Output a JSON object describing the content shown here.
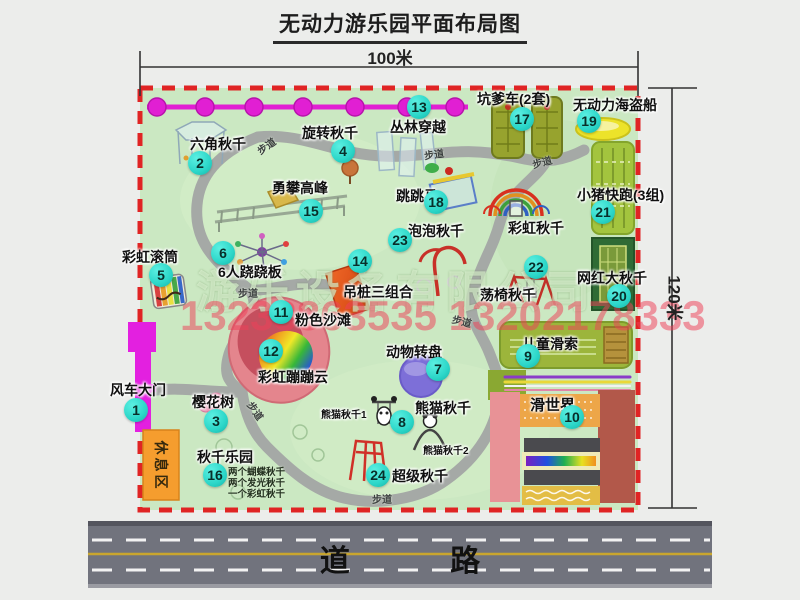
{
  "title": "无动力游乐园平面布局图",
  "dimensions": {
    "width_label": "100米",
    "height_label": "120米"
  },
  "road": {
    "label": "道 路"
  },
  "watermark": {
    "company": "游乐设备有限公司",
    "phone": "13233863535 13202178333"
  },
  "colors": {
    "map_green": "#cbe8c2",
    "border_red": "#e02424",
    "badge_cyan": "#2bd6c8",
    "chain_magenta": "#e11fd3",
    "gate_magenta": "#e320e0",
    "rest_area_orange": "#f59d2e",
    "road_gray": "#71737d"
  },
  "attractions": [
    {
      "num": "1",
      "name": "风车大门"
    },
    {
      "num": "2",
      "name": "六角秋千"
    },
    {
      "num": "3",
      "name": "樱花树"
    },
    {
      "num": "4",
      "name": "旋转秋千"
    },
    {
      "num": "5",
      "name": "彩虹滚筒"
    },
    {
      "num": "6",
      "name": "6人跷跷板"
    },
    {
      "num": "7",
      "name": "动物转盘"
    },
    {
      "num": "8",
      "name": "熊猫秋千"
    },
    {
      "num": "9",
      "name": "儿童滑索"
    },
    {
      "num": "10",
      "name": "滑世界"
    },
    {
      "num": "11",
      "name": "粉色沙滩"
    },
    {
      "num": "12",
      "name": "彩虹蹦蹦云"
    },
    {
      "num": "13",
      "name": "丛林穿越"
    },
    {
      "num": "14",
      "name": "吊桩三组合"
    },
    {
      "num": "15",
      "name": "勇攀高峰"
    },
    {
      "num": "16",
      "name": "秋千乐园",
      "notes": [
        "两个蝴蝶秋千",
        "两个发光秋千",
        "一个彩虹秋千"
      ]
    },
    {
      "num": "17",
      "name": "坑爹车(2套)"
    },
    {
      "num": "18",
      "name": "跳跳马"
    },
    {
      "num": "19",
      "name": "无动力海盗船"
    },
    {
      "num": "20",
      "name": "网红大秋千"
    },
    {
      "num": "21",
      "name": "小猪快跑(3组)"
    },
    {
      "num": "22",
      "name": "荡椅秋千"
    },
    {
      "num": "23",
      "name": "泡泡秋千"
    },
    {
      "num": "24",
      "name": "超级秋千"
    }
  ],
  "extra_labels": {
    "rainbow_swing": "彩虹秋千",
    "rest_area": "休息区",
    "panda_swing_1": "熊猫秋千1",
    "panda_swing_2": "熊猫秋千2",
    "walkway": "步道"
  }
}
